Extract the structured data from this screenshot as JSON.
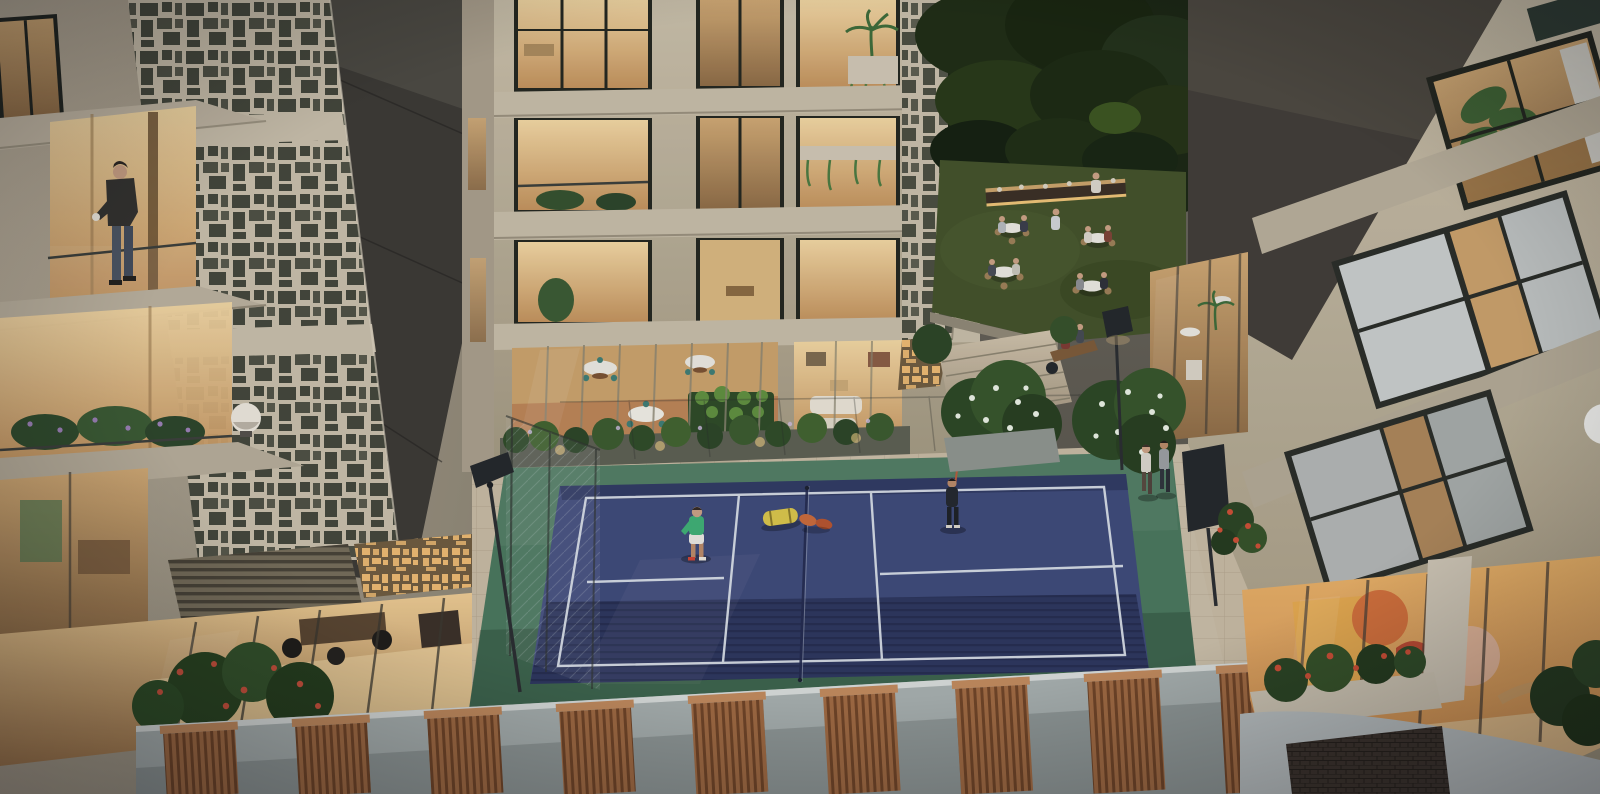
{
  "meta": {
    "type": "architectural-render",
    "time_of_day": "dusk",
    "view": "aerial-courtyard"
  },
  "palette": {
    "bg_top": "#6e6a60",
    "bg_bottom": "#4e4b43",
    "facade_cream": "#b9af9c",
    "facade_light": "#cdc3ae",
    "facade_shadow": "#8a8271",
    "wall_dark": "#3b3934",
    "wall_dark_right": "#413d37",
    "window_warm": "#eccb93",
    "window_warm_deep": "#c79a63",
    "window_dim": "#a8855c",
    "glass_cool": "#2e3b33",
    "curtain_white": "#d6dad9",
    "perforation_dark": "#3c4034",
    "perforation_gold": "#f2be74",
    "tree_dark": "#1b2614",
    "tree_light": "#3c5520",
    "lawn_green": "#43522a",
    "court_green": "#49775c",
    "court_blue": "#3e4a79",
    "court_blue_shadow": "#1b2142",
    "line_white": "#dde3ea",
    "paver_light": "#c6b9a2",
    "paver_shadow": "#9a8d76",
    "parapet_gray": "#a6aead",
    "louver_wood": "#a06a42",
    "louver_rail": "#c08a5c",
    "lamp_dark": "#23272b",
    "flower_red": "#cc4f35",
    "flower_white": "#e7efe2",
    "foliage_green": "#2f4b28",
    "kids_wall_yellow": "#e3a84f",
    "kids_wall_orange": "#d2703c",
    "skin": "#caa184",
    "player_shirt_green": "#3fae74",
    "bag_yellow": "#d9c54a",
    "paddle_orange": "#c96a3a"
  },
  "scene": {
    "court": {
      "sport": "pickleball",
      "surface_color_name": "blue",
      "apron_color_name": "green",
      "players": 2,
      "midcourt_objects": [
        "gear-bag",
        "paddles"
      ],
      "floodlights": 2
    },
    "terrace": {
      "dining_tables": 4,
      "buffet_counter": 1,
      "bench_sitters": 2,
      "diners": 9
    },
    "people": {
      "balcony_man": 1,
      "court_players": 2,
      "walkway_couple": 2
    },
    "parapet": {
      "louver_panels": 9
    },
    "buildings": {
      "left": "residential tower with perforated screens",
      "center": "balcony facade with lit interiors",
      "right": "wing with curtained windows and kids playroom"
    }
  }
}
